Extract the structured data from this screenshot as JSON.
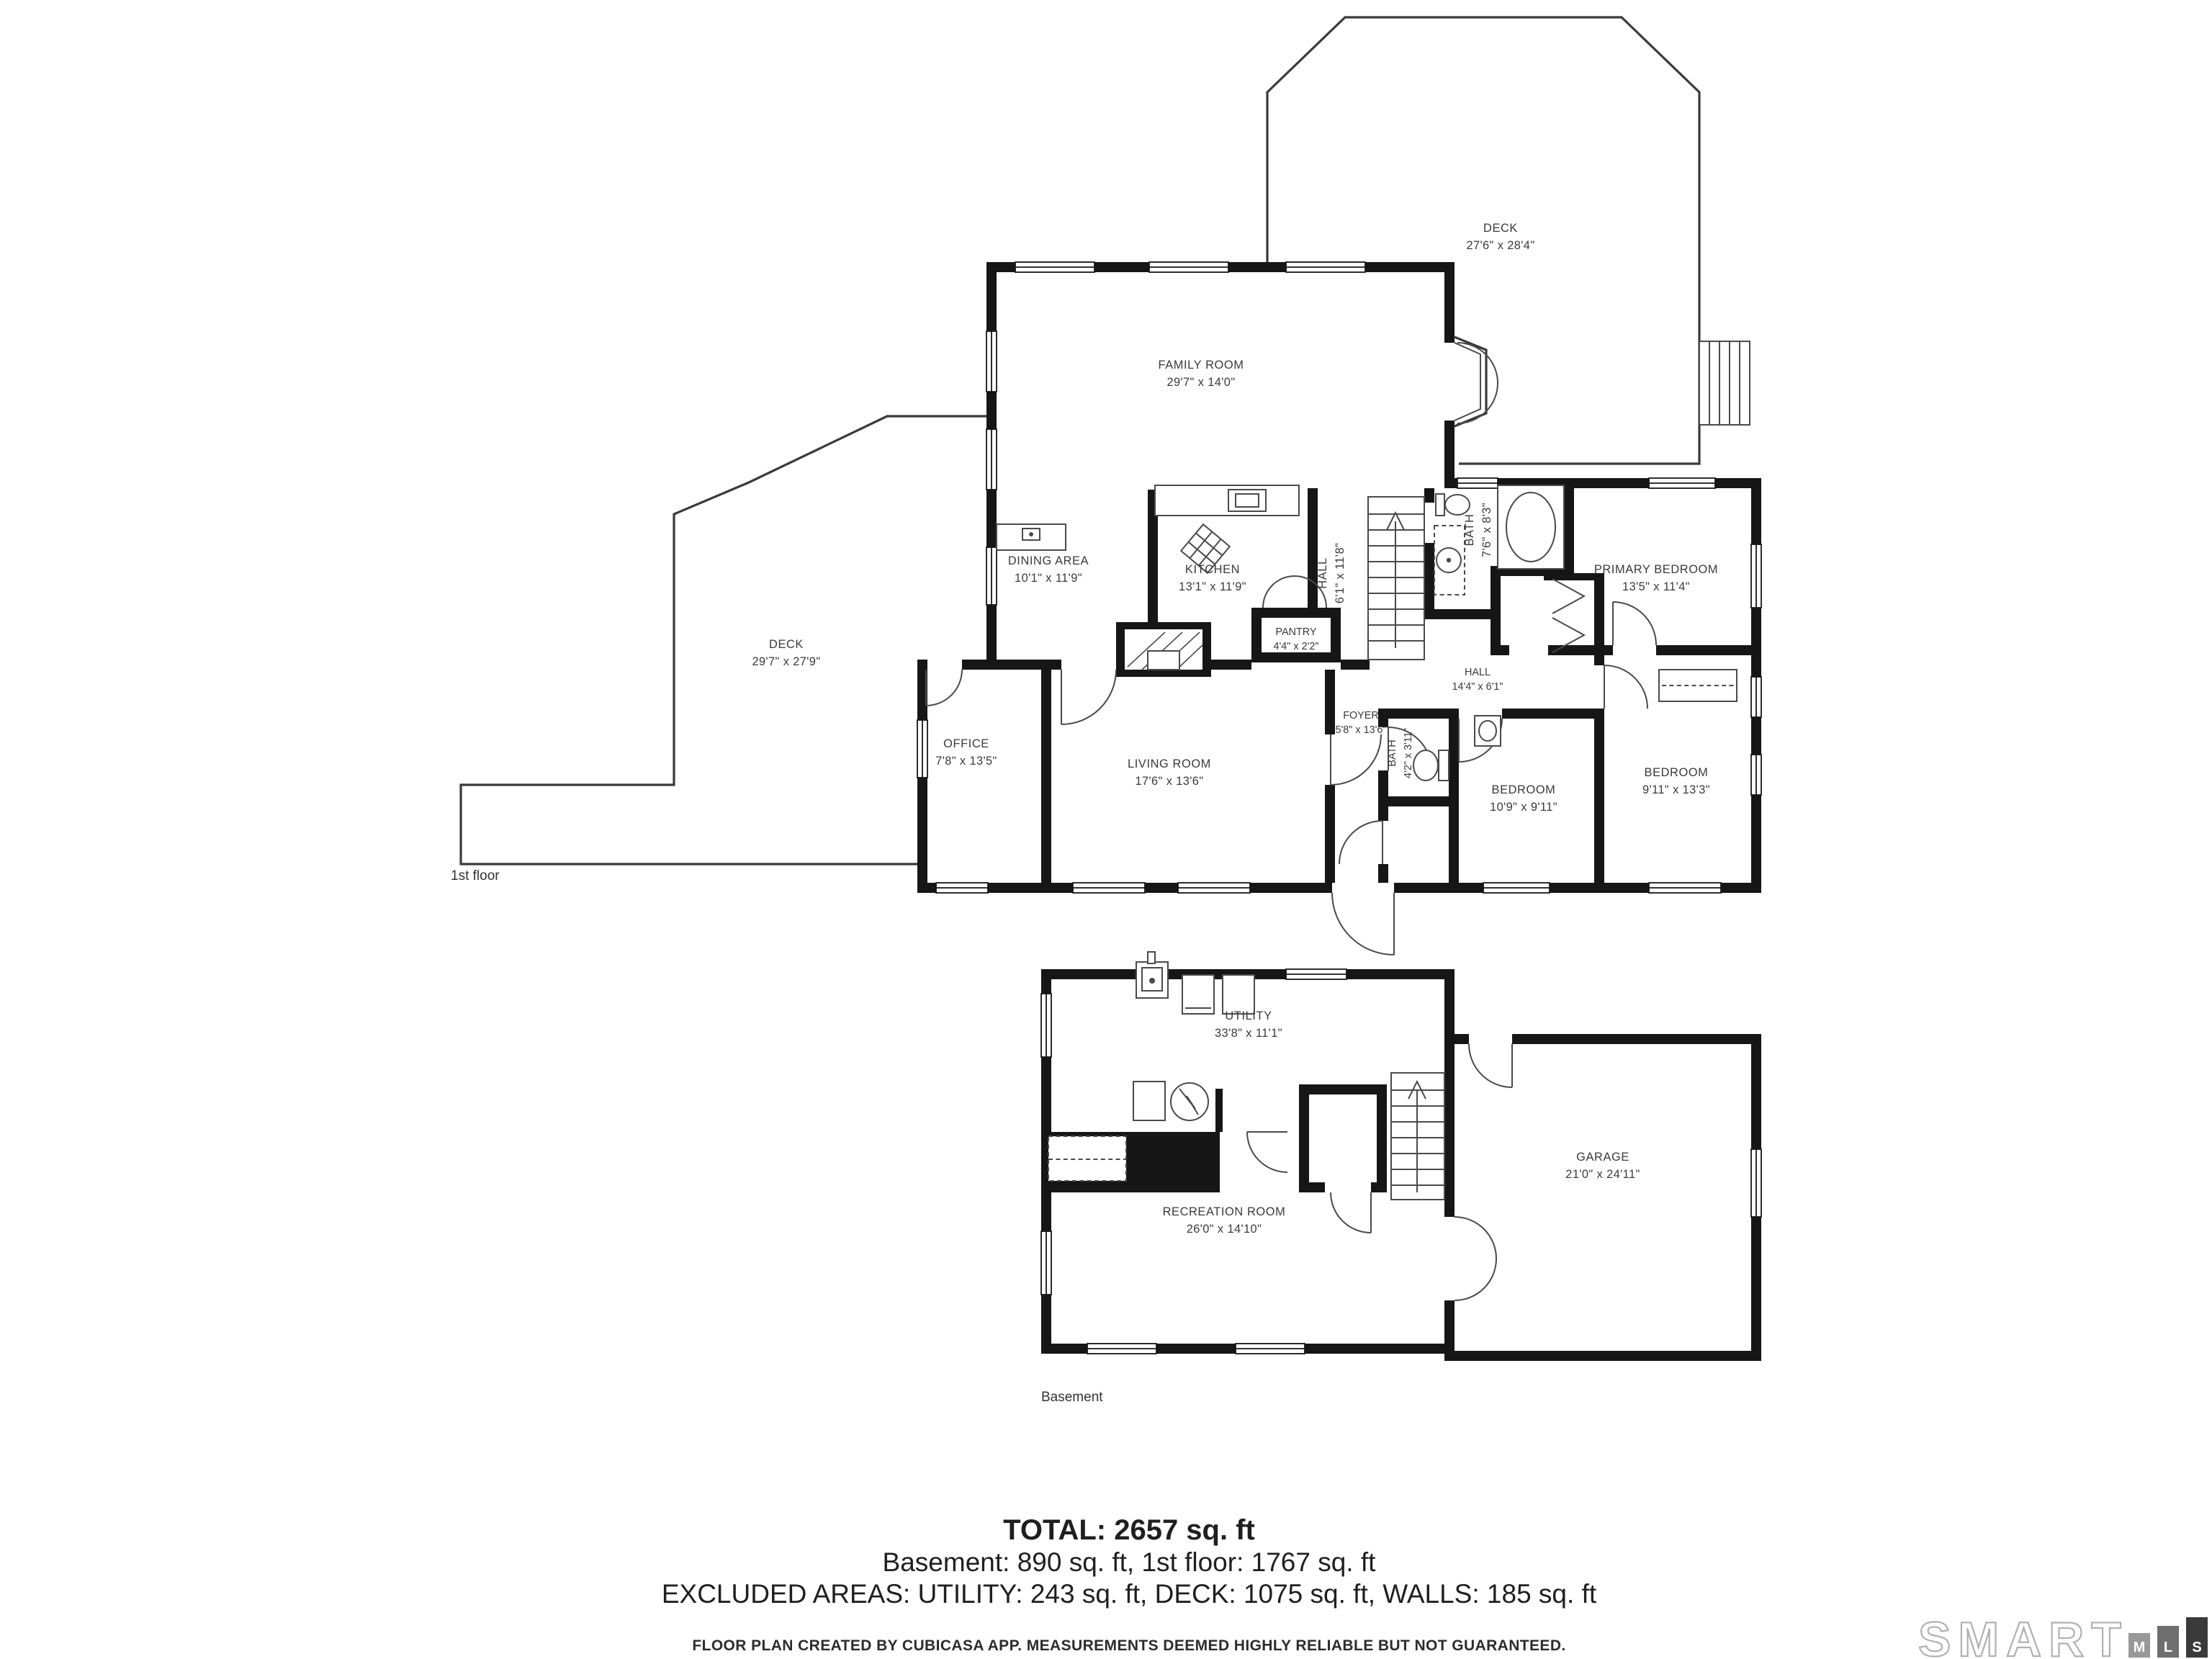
{
  "floors": [
    {
      "label": "1st floor",
      "rooms": [
        {
          "name": "DECK",
          "dims": "27'6\" x 28'4\""
        },
        {
          "name": "FAMILY ROOM",
          "dims": "29'7\" x 14'0\""
        },
        {
          "name": "DINING AREA",
          "dims": "10'1\" x 11'9\""
        },
        {
          "name": "KITCHEN",
          "dims": "13'1\" x 11'9\""
        },
        {
          "name": "HALL",
          "dims": "6'1\" x 11'8\""
        },
        {
          "name": "BATH",
          "dims": "7'6\" x 8'3\""
        },
        {
          "name": "PRIMARY BEDROOM",
          "dims": "13'5\" x 11'4\""
        },
        {
          "name": "DECK",
          "dims": "29'7\" x 27'9\""
        },
        {
          "name": "OFFICE",
          "dims": "7'8\" x 13'5\""
        },
        {
          "name": "LIVING ROOM",
          "dims": "17'6\" x 13'6\""
        },
        {
          "name": "FOYER",
          "dims": "5'8\" x 13'6\""
        },
        {
          "name": "BATH",
          "dims": "4'2\" x 3'11\""
        },
        {
          "name": "HALL",
          "dims": "14'4\" x 6'1\""
        },
        {
          "name": "PANTRY",
          "dims": "4'4\" x 2'2\""
        },
        {
          "name": "BEDROOM",
          "dims": "10'9\" x 9'11\""
        },
        {
          "name": "BEDROOM",
          "dims": "9'11\" x 13'3\""
        }
      ]
    },
    {
      "label": "Basement",
      "rooms": [
        {
          "name": "UTILITY",
          "dims": "33'8\" x 11'1\""
        },
        {
          "name": "RECREATION ROOM",
          "dims": "26'0\" x 14'10\""
        },
        {
          "name": "GARAGE",
          "dims": "21'0\" x 24'11\""
        }
      ]
    }
  ],
  "summary": {
    "total": "TOTAL: 2657 sq. ft",
    "breakdown": "Basement: 890 sq. ft, 1st floor: 1767 sq. ft",
    "excluded": "EXCLUDED AREAS: UTILITY: 243 sq. ft, DECK: 1075 sq. ft, WALLS: 185 sq. ft"
  },
  "footer": {
    "disclaimer": "FLOOR PLAN CREATED BY CUBICASA APP. MEASUREMENTS DEEMED HIGHLY RELIABLE BUT NOT GUARANTEED."
  },
  "logo": {
    "brand": "SMART",
    "blocks": [
      "M",
      "L",
      "S"
    ]
  },
  "colors": {
    "wall": "#161616",
    "line": "#4a4a4a",
    "text": "#3a3a3a"
  }
}
